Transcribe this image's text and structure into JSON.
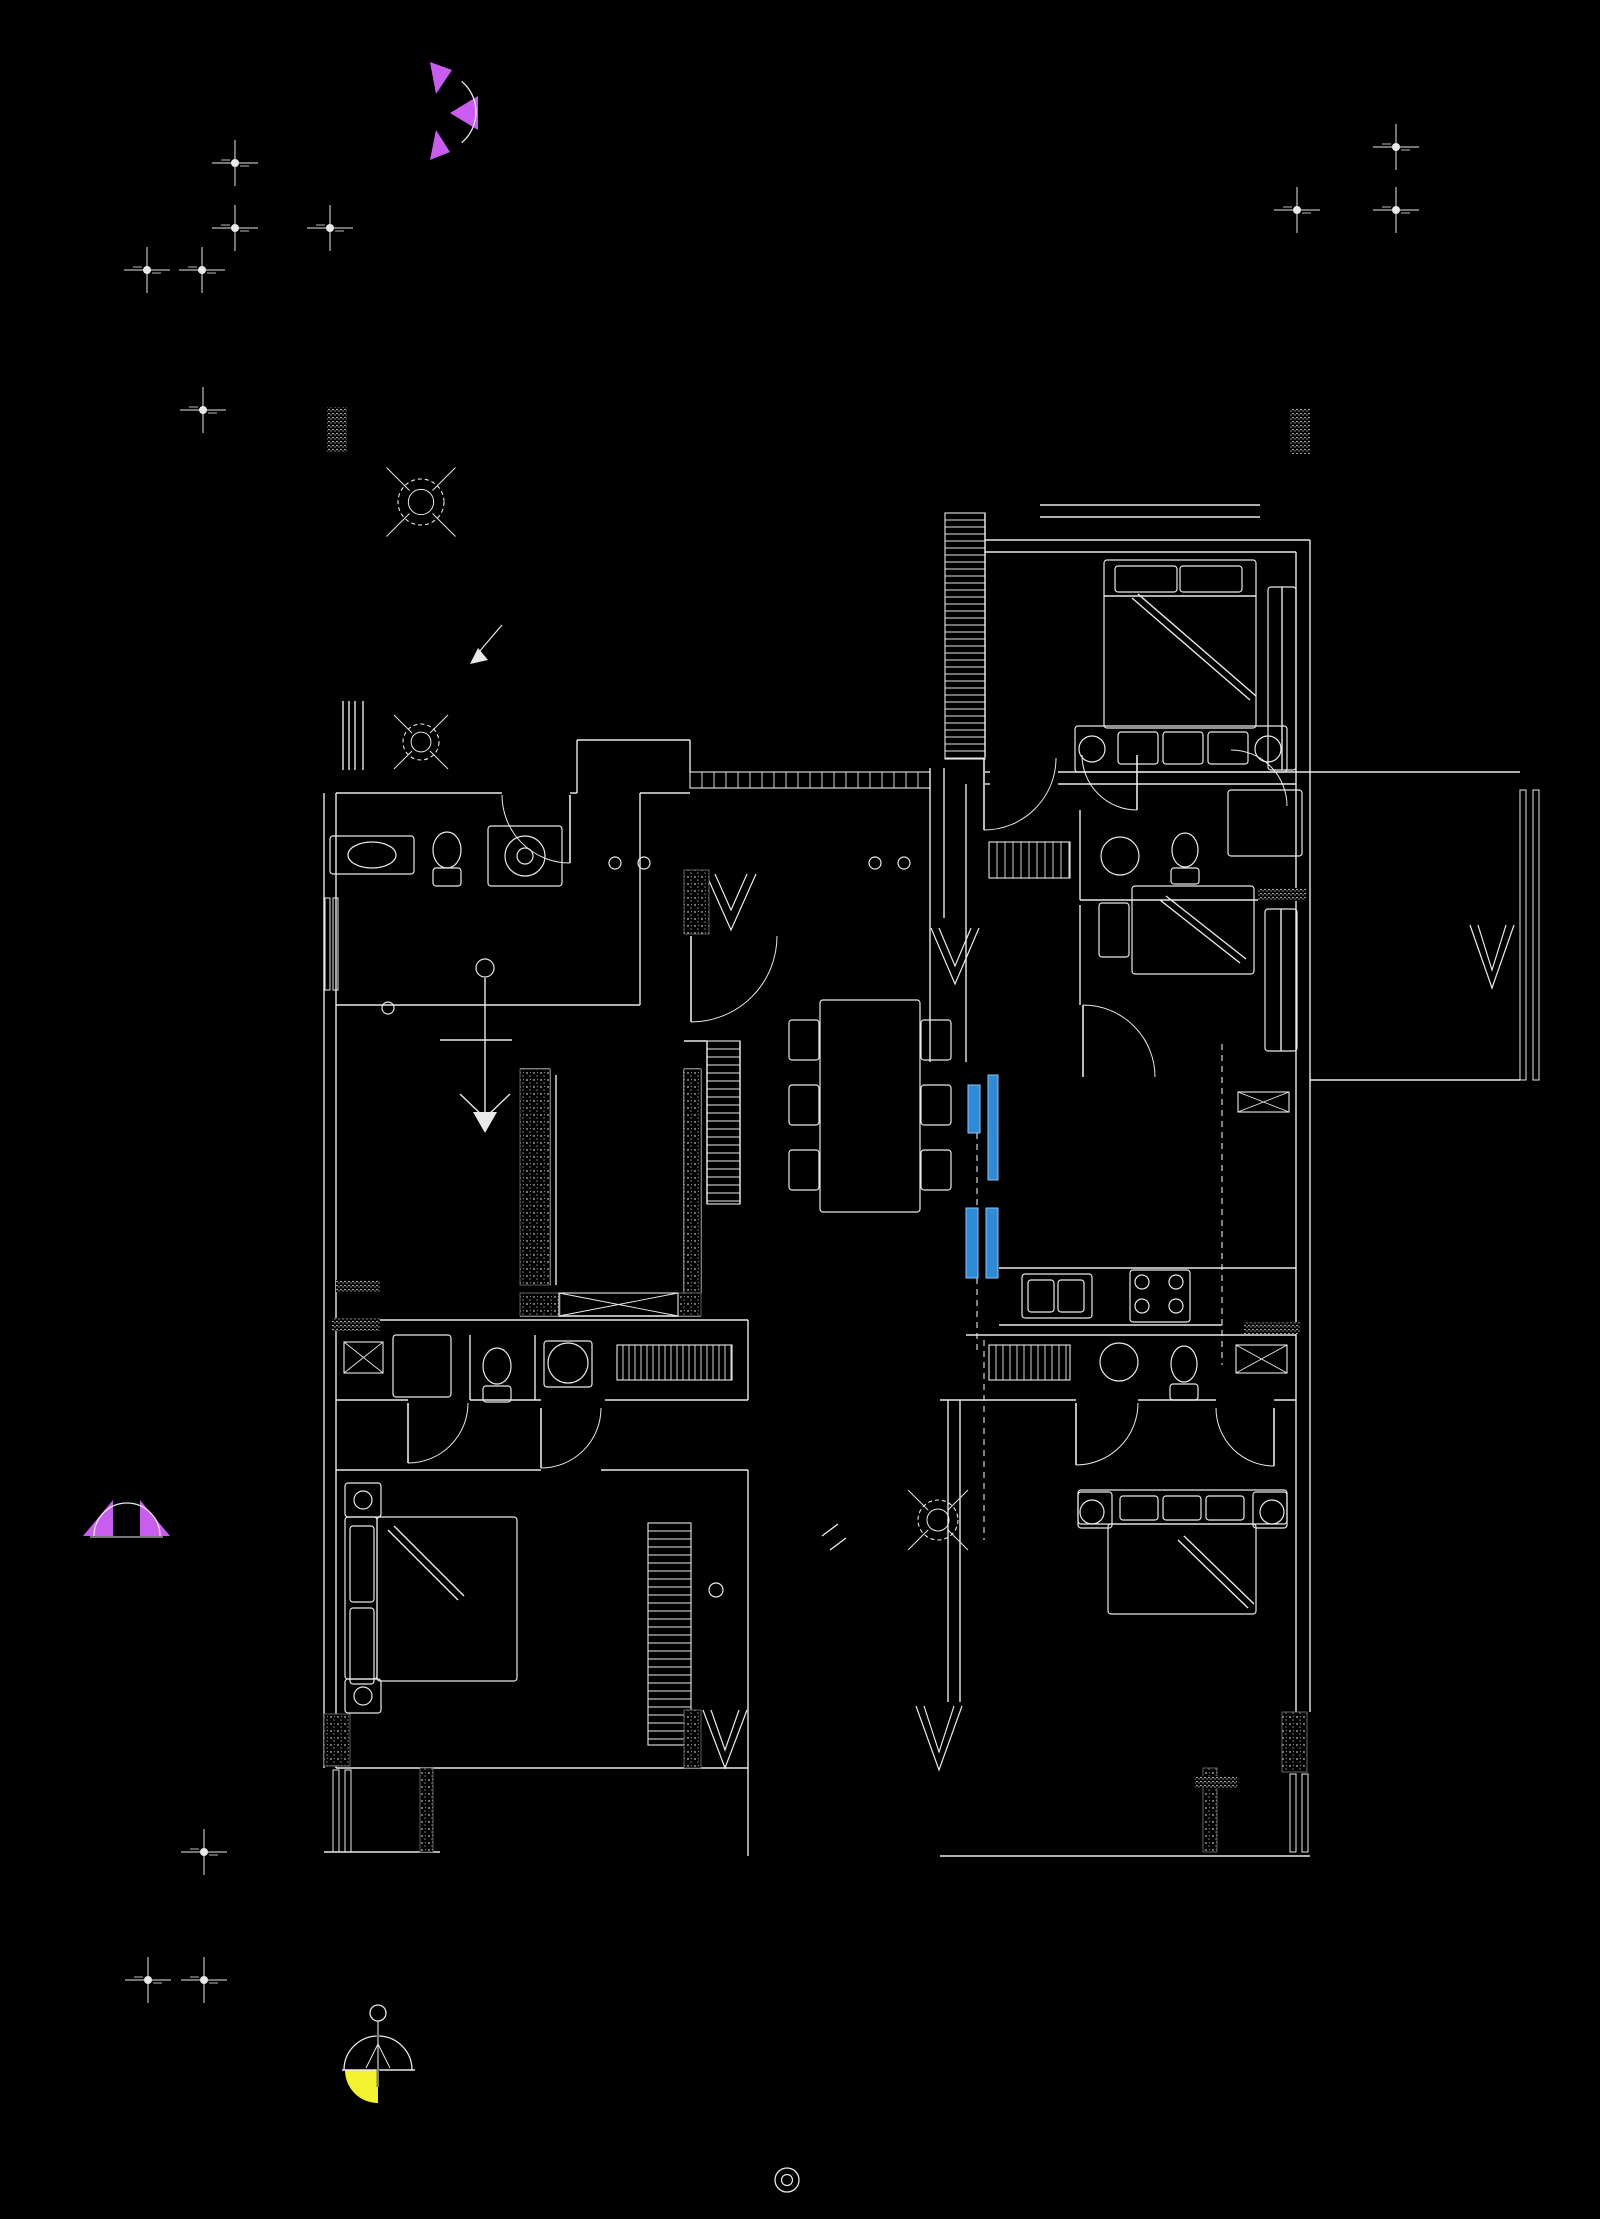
{
  "meta": {
    "canvas": {
      "w": 1600,
      "h": 2219
    },
    "kind": "cad-architectural-floor-plan"
  },
  "colors": {
    "background": "#000000",
    "line": "#e9e9e9",
    "stipple": "#9a9a9a",
    "blue": "#2e8bd8",
    "blue_edge": "#8fc3ee",
    "purple": "#c95df0",
    "yellow": "#f2f22e"
  },
  "drawing": {
    "walls": [
      [
        375,
        793,
        502,
        793
      ],
      [
        570,
        793,
        577,
        793
      ],
      [
        577,
        740,
        577,
        793
      ],
      [
        577,
        740,
        690,
        740
      ],
      [
        690,
        740,
        690,
        772
      ],
      [
        324,
        793,
        324,
        1768
      ],
      [
        336,
        793,
        336,
        1768
      ],
      [
        336,
        793,
        375,
        793
      ],
      [
        336,
        1005,
        640,
        1005
      ],
      [
        640,
        793,
        640,
        1005
      ],
      [
        640,
        793,
        690,
        793
      ],
      [
        930,
        768,
        930,
        1062
      ],
      [
        944,
        768,
        944,
        918
      ],
      [
        985,
        513,
        985,
        757
      ],
      [
        985,
        540,
        1310,
        540
      ],
      [
        985,
        552,
        1296,
        552
      ],
      [
        1040,
        505,
        1260,
        505
      ],
      [
        1040,
        517,
        1260,
        517
      ],
      [
        985,
        772,
        990,
        772
      ],
      [
        1058,
        772,
        1310,
        772
      ],
      [
        985,
        784,
        990,
        784
      ],
      [
        1058,
        784,
        1296,
        784
      ],
      [
        1080,
        810,
        1080,
        900
      ],
      [
        1080,
        900,
        1296,
        900
      ],
      [
        1080,
        905,
        1080,
        1005
      ],
      [
        966,
        784,
        966,
        1062
      ],
      [
        1296,
        552,
        1296,
        1712
      ],
      [
        1310,
        540,
        1310,
        1712
      ],
      [
        999,
        1268,
        1296,
        1268
      ],
      [
        999,
        1325,
        1222,
        1325
      ],
      [
        966,
        1335,
        1296,
        1335
      ],
      [
        940,
        1400,
        1076,
        1400
      ],
      [
        1138,
        1400,
        1216,
        1400
      ],
      [
        1274,
        1400,
        1296,
        1400
      ],
      [
        948,
        1400,
        948,
        1702
      ],
      [
        960,
        1400,
        960,
        1702
      ],
      [
        336,
        1320,
        748,
        1320
      ],
      [
        336,
        1400,
        408,
        1400
      ],
      [
        470,
        1400,
        541,
        1400
      ],
      [
        605,
        1400,
        748,
        1400
      ],
      [
        748,
        1320,
        748,
        1400
      ],
      [
        470,
        1335,
        470,
        1400
      ],
      [
        535,
        1335,
        535,
        1400
      ],
      [
        336,
        1470,
        541,
        1470
      ],
      [
        601,
        1470,
        748,
        1470
      ],
      [
        748,
        1470,
        748,
        1856
      ],
      [
        336,
        1768,
        748,
        1768
      ],
      [
        324,
        1852,
        440,
        1852
      ],
      [
        940,
        1856,
        1310,
        1856
      ],
      [
        1310,
        772,
        1520,
        772
      ],
      [
        1310,
        1080,
        1520,
        1080
      ],
      [
        520,
        1069,
        550,
        1069
      ],
      [
        550,
        1069,
        550,
        1285
      ],
      [
        556,
        1075,
        556,
        1285
      ],
      [
        520,
        1316,
        701,
        1316
      ],
      [
        684,
        1069,
        684,
        1293
      ],
      [
        701,
        1069,
        701,
        1293
      ],
      [
        684,
        1069,
        701,
        1069
      ],
      [
        707,
        1041,
        707,
        1204
      ],
      [
        740,
        1041,
        740,
        1204
      ],
      [
        684,
        1041,
        707,
        1041
      ],
      [
        1104,
        596,
        1256,
        596
      ],
      [
        343,
        701,
        343,
        770
      ],
      [
        363,
        701,
        363,
        770
      ],
      [
        349,
        701,
        349,
        770
      ],
      [
        355,
        701,
        355,
        770
      ],
      [
        1282,
        587,
        1282,
        770
      ],
      [
        1281,
        909,
        1281,
        1051
      ],
      [
        1132,
        598,
        1250,
        700
      ],
      [
        1138,
        594,
        1256,
        696
      ],
      [
        1160,
        900,
        1240,
        963
      ],
      [
        1166,
        896,
        1246,
        959
      ],
      [
        388,
        1530,
        458,
        1600
      ],
      [
        394,
        1526,
        464,
        1596
      ],
      [
        1178,
        1540,
        1248,
        1608
      ],
      [
        1184,
        1536,
        1254,
        1604
      ],
      [
        485,
        978,
        485,
        1118
      ],
      [
        440,
        1040,
        512,
        1040
      ],
      [
        485,
        1118,
        460,
        1094
      ],
      [
        485,
        1118,
        510,
        1094
      ],
      [
        822,
        1536,
        838,
        1524
      ],
      [
        830,
        1550,
        846,
        1538
      ]
    ],
    "dashed": [
      [
        1222,
        1044,
        1222,
        1365
      ],
      [
        984,
        1340,
        984,
        1540
      ],
      [
        977,
        1133,
        977,
        1208
      ],
      [
        977,
        1278,
        977,
        1350
      ]
    ],
    "rects": [
      [
        330,
        836,
        84,
        38
      ],
      [
        488,
        826,
        74,
        60
      ],
      [
        433,
        868,
        28,
        18
      ],
      [
        1104,
        560,
        152,
        168
      ],
      [
        1075,
        726,
        212,
        46
      ],
      [
        1118,
        732,
        40,
        32
      ],
      [
        1163,
        732,
        40,
        32
      ],
      [
        1208,
        732,
        40,
        32
      ],
      [
        1268,
        587,
        28,
        183
      ],
      [
        1228,
        790,
        74,
        66
      ],
      [
        1099,
        903,
        30,
        54
      ],
      [
        1132,
        886,
        122,
        88
      ],
      [
        1265,
        909,
        32,
        142
      ],
      [
        1022,
        1274,
        70,
        44
      ],
      [
        1028,
        1280,
        26,
        32
      ],
      [
        1058,
        1280,
        26,
        32
      ],
      [
        1130,
        1270,
        60,
        52
      ],
      [
        820,
        1000,
        100,
        212
      ],
      [
        789,
        1020,
        30,
        40
      ],
      [
        789,
        1085,
        30,
        40
      ],
      [
        789,
        1150,
        30,
        40
      ],
      [
        921,
        1020,
        30,
        40
      ],
      [
        921,
        1085,
        30,
        40
      ],
      [
        921,
        1150,
        30,
        40
      ],
      [
        544,
        1341,
        48,
        46
      ],
      [
        483,
        1386,
        28,
        16
      ],
      [
        393,
        1335,
        58,
        62
      ],
      [
        345,
        1483,
        36,
        34
      ],
      [
        345,
        1679,
        36,
        34
      ],
      [
        345,
        1517,
        32,
        162
      ],
      [
        377,
        1517,
        140,
        164
      ],
      [
        350,
        1526,
        24,
        76
      ],
      [
        350,
        1608,
        24,
        76
      ],
      [
        1078,
        1490,
        209,
        34
      ],
      [
        1078,
        1492,
        34,
        36
      ],
      [
        1253,
        1492,
        34,
        36
      ],
      [
        1108,
        1524,
        148,
        90
      ],
      [
        1120,
        1496,
        38,
        24
      ],
      [
        1163,
        1496,
        38,
        24
      ],
      [
        1206,
        1496,
        38,
        24
      ],
      [
        1115,
        566,
        62,
        26
      ],
      [
        1180,
        566,
        62,
        26
      ],
      [
        1170,
        1384,
        28,
        16
      ],
      [
        1171,
        868,
        28,
        16
      ]
    ],
    "windows": [
      [
        325,
        898,
        5,
        92
      ],
      [
        333,
        898,
        5,
        92
      ],
      [
        1520,
        790,
        6,
        290
      ],
      [
        1533,
        790,
        6,
        290
      ],
      [
        333,
        1770,
        6,
        82
      ],
      [
        345,
        1770,
        6,
        82
      ],
      [
        1290,
        1774,
        6,
        78
      ],
      [
        1302,
        1774,
        6,
        78
      ]
    ],
    "circles": [
      [
        525,
        856,
        20
      ],
      [
        525,
        856,
        8
      ],
      [
        568,
        1363,
        20
      ],
      [
        1119,
        1362,
        19
      ],
      [
        1120,
        856,
        19
      ],
      [
        1142,
        1282,
        7
      ],
      [
        1176,
        1282,
        7
      ],
      [
        1142,
        1306,
        7
      ],
      [
        1176,
        1306,
        7
      ],
      [
        615,
        863,
        6
      ],
      [
        644,
        863,
        6
      ],
      [
        875,
        863,
        6
      ],
      [
        904,
        863,
        6
      ],
      [
        716,
        1590,
        7
      ],
      [
        388,
        1008,
        6
      ],
      [
        1092,
        749,
        13
      ],
      [
        1268,
        749,
        13
      ],
      [
        363,
        1500,
        9
      ],
      [
        363,
        1696,
        9
      ],
      [
        1092,
        1512,
        12
      ],
      [
        1272,
        1512,
        12
      ],
      [
        485,
        968,
        9
      ]
    ],
    "ellipses": [
      [
        447,
        850,
        14,
        18
      ],
      [
        497,
        1366,
        14,
        18
      ],
      [
        1184,
        1364,
        13,
        18
      ],
      [
        1185,
        850,
        13,
        17
      ],
      [
        372,
        855,
        24,
        13
      ]
    ],
    "polylines": [
      [
        706,
        874,
        731,
        930,
        756,
        874
      ],
      [
        715,
        874,
        731,
        910,
        747,
        874
      ],
      [
        931,
        928,
        955,
        984,
        979,
        928
      ],
      [
        939,
        928,
        955,
        966,
        971,
        928
      ],
      [
        703,
        1710,
        725,
        1768,
        747,
        1710
      ],
      [
        711,
        1710,
        725,
        1750,
        739,
        1710
      ],
      [
        916,
        1706,
        939,
        1770,
        962,
        1706
      ],
      [
        924,
        1706,
        939,
        1752,
        954,
        1706
      ],
      [
        1470,
        925,
        1492,
        988,
        1514,
        925
      ],
      [
        1478,
        925,
        1492,
        970,
        1506,
        925
      ],
      [
        502,
        625,
        484,
        646,
        472,
        661
      ]
    ],
    "polygons": [
      [
        485,
        1133,
        473,
        1112,
        497,
        1112
      ],
      [
        470,
        664,
        478,
        648,
        488,
        660
      ]
    ],
    "hatchV": [
      [
        945,
        513,
        40,
        246,
        7
      ],
      [
        707,
        1041,
        33,
        163,
        8
      ],
      [
        648,
        1523,
        43,
        222,
        8
      ]
    ],
    "hatchH": [
      [
        690,
        772,
        240,
        16,
        12
      ],
      [
        989,
        842,
        81,
        36,
        8
      ],
      [
        617,
        1345,
        115,
        35,
        6
      ],
      [
        989,
        1345,
        81,
        35,
        7
      ]
    ],
    "stipples": [
      [
        520,
        1069,
        30,
        216
      ],
      [
        684,
        1069,
        17,
        224
      ],
      [
        520,
        1293,
        40,
        23
      ],
      [
        678,
        1293,
        23,
        23
      ],
      [
        684,
        870,
        25,
        64
      ],
      [
        324,
        1714,
        26,
        52
      ],
      [
        684,
        1710,
        17,
        58
      ],
      [
        1282,
        1712,
        25,
        60
      ],
      [
        1203,
        1768,
        14,
        84
      ],
      [
        420,
        1768,
        13,
        84
      ]
    ],
    "labels": [
      [
        327,
        407,
        20,
        46
      ],
      [
        1290,
        408,
        20,
        46
      ],
      [
        1258,
        888,
        48,
        13
      ],
      [
        332,
        1318,
        48,
        13
      ],
      [
        1244,
        1322,
        56,
        12
      ],
      [
        336,
        1280,
        44,
        12
      ],
      [
        1195,
        1776,
        42,
        12
      ]
    ],
    "xboxes": [
      [
        344,
        1342,
        39,
        31
      ],
      [
        559,
        1293,
        119,
        23
      ],
      [
        1236,
        1345,
        51,
        28
      ],
      [
        1238,
        1092,
        51,
        20
      ]
    ],
    "doors": [
      {
        "cx": 570,
        "cy": 795,
        "r": 68,
        "a1": 90,
        "a2": 180,
        "leaf": [
          570,
          795,
          570,
          863
        ]
      },
      {
        "cx": 691,
        "cy": 936,
        "r": 86,
        "a1": 0,
        "a2": 90,
        "leaf": [
          691,
          936,
          691,
          1022
        ]
      },
      {
        "cx": 984,
        "cy": 758,
        "r": 72,
        "a1": 0,
        "a2": 90,
        "leaf": [
          984,
          758,
          984,
          830
        ]
      },
      {
        "cx": 1137,
        "cy": 755,
        "r": 55,
        "a1": 90,
        "a2": 180,
        "leaf": [
          1137,
          755,
          1137,
          810
        ]
      },
      {
        "cx": 1231,
        "cy": 806,
        "r": 56,
        "a1": 270,
        "a2": 360,
        "leaf": null
      },
      {
        "cx": 1083,
        "cy": 1077,
        "r": 72,
        "a1": 270,
        "a2": 360,
        "leaf": [
          1083,
          1005,
          1083,
          1077
        ]
      },
      {
        "cx": 408,
        "cy": 1403,
        "r": 60,
        "a1": 0,
        "a2": 90,
        "leaf": [
          408,
          1403,
          408,
          1463
        ]
      },
      {
        "cx": 541,
        "cy": 1408,
        "r": 60,
        "a1": 0,
        "a2": 90,
        "leaf": [
          541,
          1408,
          541,
          1468
        ]
      },
      {
        "cx": 1076,
        "cy": 1403,
        "r": 62,
        "a1": 0,
        "a2": 90,
        "leaf": [
          1076,
          1403,
          1076,
          1465
        ]
      },
      {
        "cx": 1274,
        "cy": 1408,
        "r": 58,
        "a1": 90,
        "a2": 180,
        "leaf": [
          1274,
          1408,
          1274,
          1466
        ]
      }
    ],
    "fans": [
      [
        421,
        502,
        23
      ],
      [
        421,
        742,
        18
      ],
      [
        938,
        1520,
        20
      ]
    ],
    "crosses": [
      [
        235,
        163
      ],
      [
        235,
        228
      ],
      [
        330,
        228
      ],
      [
        147,
        270
      ],
      [
        202,
        270
      ],
      [
        203,
        410
      ],
      [
        1396,
        147
      ],
      [
        1396,
        210
      ],
      [
        1297,
        210
      ],
      [
        204,
        1852
      ],
      [
        148,
        1980
      ],
      [
        204,
        1980
      ]
    ],
    "blue_panels": [
      [
        968,
        1085,
        12,
        48
      ],
      [
        988,
        1075,
        10,
        105
      ],
      [
        966,
        1208,
        12,
        70
      ],
      [
        986,
        1208,
        12,
        70
      ]
    ],
    "purple_marks": {
      "triangles": [
        [
          430,
          62,
          452,
          70,
          436,
          94
        ],
        [
          478,
          96,
          478,
          130,
          450,
          113
        ],
        [
          430,
          160,
          450,
          152,
          436,
          130
        ],
        [
          83,
          1536,
          113,
          1500,
          113,
          1536
        ],
        [
          140,
          1500,
          170,
          1536,
          140,
          1536
        ]
      ],
      "arcs": [
        {
          "cx": 436,
          "cy": 112,
          "r": 40,
          "a1": -50,
          "a2": 50
        },
        {
          "cx": 127,
          "cy": 1536,
          "r": 33,
          "a1": 180,
          "a2": 360
        }
      ],
      "base_line": [
        90,
        1537,
        163,
        1537
      ]
    },
    "yellow_symbol": {
      "circle": [
        378,
        2013,
        8
      ],
      "stem": [
        378,
        2021,
        378,
        2087
      ],
      "dome": {
        "cx": 378,
        "cy": 2070,
        "r": 34,
        "a1": 180,
        "a2": 360
      },
      "base": [
        342,
        2070,
        415,
        2070
      ],
      "legs": [
        [
          378,
          2044,
          366,
          2068
        ],
        [
          378,
          2044,
          390,
          2068
        ]
      ],
      "wedge": {
        "cx": 378,
        "cy": 2070,
        "r": 33
      }
    },
    "target": [
      787,
      2180,
      12,
      5.5
    ]
  }
}
